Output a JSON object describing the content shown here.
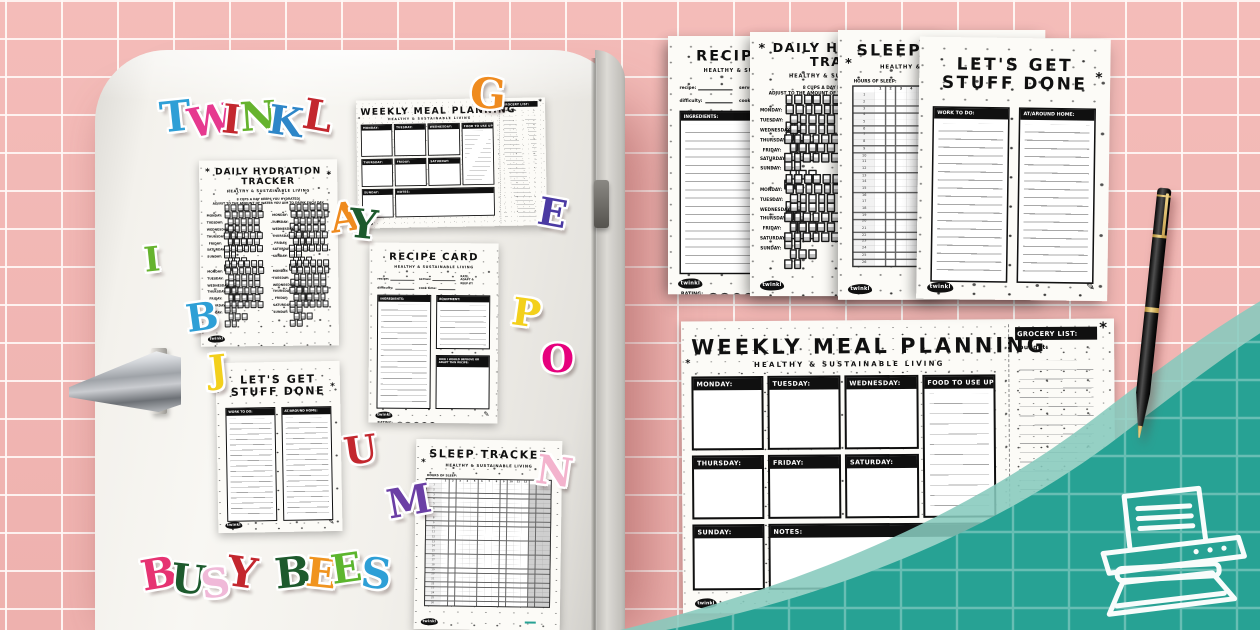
{
  "background": {
    "tile_color": "#f1b6b3",
    "grout_color": "#fdf1ef",
    "teal": "#27a294",
    "teal_light": "#86cabd"
  },
  "brand": {
    "logo": "twinkl"
  },
  "days": [
    "MONDAY:",
    "TUESDAY:",
    "WEDNESDAY:",
    "THURSDAY:",
    "FRIDAY:",
    "SATURDAY:",
    "SUNDAY:"
  ],
  "hydration": {
    "title_line1": "DAILY HYDRATION",
    "title_line2": "TRACKER",
    "subtitle": "HEALTHY & SUSTAINABLE LIVING",
    "intro_line1": "8 CUPS A DAY KEEPS YOU HYDRATED!",
    "intro_line2": "ADJUST TO THE AMOUNT OF WATER YOU AIM TO DRINK EACH DAY.",
    "cups_per_day": 8
  },
  "sleep": {
    "title": "SLEEP TRACKER",
    "subtitle": "HEALTHY & SUSTAINABLE LIVING",
    "grid_label": "HOURS OF SLEEP:",
    "hour_columns": [
      "1",
      "2",
      "3",
      "4",
      "5",
      "6",
      "7",
      "8",
      "9",
      "10",
      "11",
      "12"
    ]
  },
  "todo": {
    "title_line1": "LET'S GET",
    "title_line2": "STUFF DONE",
    "col1_label": "WORK TO DO:",
    "col2_label": "AT/AROUND HOME:"
  },
  "recipe": {
    "title": "RECIPE CARD",
    "subtitle": "HEALTHY & SUSTAINABLE LIVING",
    "fields": [
      "recipe:",
      "serves:",
      "difficulty:",
      "cook time:"
    ],
    "note_lines": [
      "RATE,",
      "ADAPT &",
      "KEEP IT!"
    ],
    "ingredients_label": "INGREDIENTS:",
    "equipment_label": "EQUIPMENT:",
    "improve_label": "HOW I WOULD IMPROVE OR ADAPT THIS RECIPE:",
    "rating_label": "RATING:",
    "rating_circles": 5
  },
  "meal": {
    "title": "WEEKLY MEAL PLANNING",
    "subtitle": "HEALTHY & SUSTAINABLE LIVING",
    "day_boxes_row1": [
      "MONDAY:",
      "TUESDAY:",
      "WEDNESDAY:"
    ],
    "use_up_label": "FOOD TO USE UP:",
    "day_boxes_row2": [
      "THURSDAY:",
      "FRIDAY:",
      "SATURDAY:"
    ],
    "sunday_label": "SUNDAY:",
    "notes_label": "NOTES:",
    "grocery_label": "GROCERY LIST:",
    "budget_label": "budget:"
  },
  "letters": [
    {
      "ch": "T",
      "color": "#2e9fd6",
      "x": 160,
      "y": 96,
      "size": 42,
      "rot": -6
    },
    {
      "ch": "W",
      "color": "#e6398f",
      "x": 188,
      "y": 101,
      "size": 40,
      "rot": -10
    },
    {
      "ch": "I",
      "color": "#c3272e",
      "x": 222,
      "y": 100,
      "size": 40,
      "rot": 6
    },
    {
      "ch": "N",
      "color": "#66b32e",
      "x": 240,
      "y": 97,
      "size": 40,
      "rot": -4
    },
    {
      "ch": "K",
      "color": "#2e86c8",
      "x": 268,
      "y": 102,
      "size": 40,
      "rot": 8
    },
    {
      "ch": "L",
      "color": "#c3272e",
      "x": 303,
      "y": 95,
      "size": 42,
      "rot": 10
    },
    {
      "ch": "G",
      "color": "#ef8b1f",
      "x": 470,
      "y": 73,
      "size": 42,
      "rot": 4
    },
    {
      "ch": "A",
      "color": "#ef8b1f",
      "x": 330,
      "y": 198,
      "size": 40,
      "rot": -8
    },
    {
      "ch": "Y",
      "color": "#1d5a2d",
      "x": 349,
      "y": 205,
      "size": 40,
      "rot": 6
    },
    {
      "ch": "E",
      "color": "#4b3aa3",
      "x": 538,
      "y": 194,
      "size": 38,
      "rot": 10
    },
    {
      "ch": "I",
      "color": "#66b32e",
      "x": 144,
      "y": 243,
      "size": 34,
      "rot": -6
    },
    {
      "ch": "B",
      "color": "#2e9fd6",
      "x": 186,
      "y": 298,
      "size": 38,
      "rot": -8
    },
    {
      "ch": "P",
      "color": "#f3d01c",
      "x": 512,
      "y": 294,
      "size": 38,
      "rot": 8
    },
    {
      "ch": "O",
      "color": "#e6007d",
      "x": 541,
      "y": 340,
      "size": 38,
      "rot": 0
    },
    {
      "ch": "J",
      "color": "#f3d01c",
      "x": 209,
      "y": 350,
      "size": 38,
      "rot": -6
    },
    {
      "ch": "U",
      "color": "#c3272e",
      "x": 344,
      "y": 431,
      "size": 38,
      "rot": -8
    },
    {
      "ch": "M",
      "color": "#6b3fa5",
      "x": 387,
      "y": 482,
      "size": 40,
      "rot": -10
    },
    {
      "ch": "N",
      "color": "#f3b3cd",
      "x": 536,
      "y": 452,
      "size": 40,
      "rot": 8
    },
    {
      "ch": "B",
      "color": "#e63372",
      "x": 141,
      "y": 553,
      "size": 42,
      "rot": -10
    },
    {
      "ch": "U",
      "color": "#1d5a2d",
      "x": 171,
      "y": 560,
      "size": 40,
      "rot": 6
    },
    {
      "ch": "S",
      "color": "#f0b9d8",
      "x": 201,
      "y": 564,
      "size": 40,
      "rot": -8
    },
    {
      "ch": "Y",
      "color": "#c3272e",
      "x": 227,
      "y": 552,
      "size": 42,
      "rot": 8
    },
    {
      "ch": "B",
      "color": "#1d5a2d",
      "x": 275,
      "y": 552,
      "size": 42,
      "rot": -6
    },
    {
      "ch": "E",
      "color": "#f0941f",
      "x": 306,
      "y": 554,
      "size": 40,
      "rot": 6
    },
    {
      "ch": "E",
      "color": "#5cb52e",
      "x": 331,
      "y": 549,
      "size": 40,
      "rot": -8
    },
    {
      "ch": "S",
      "color": "#2e9fd6",
      "x": 361,
      "y": 553,
      "size": 42,
      "rot": 6
    }
  ]
}
